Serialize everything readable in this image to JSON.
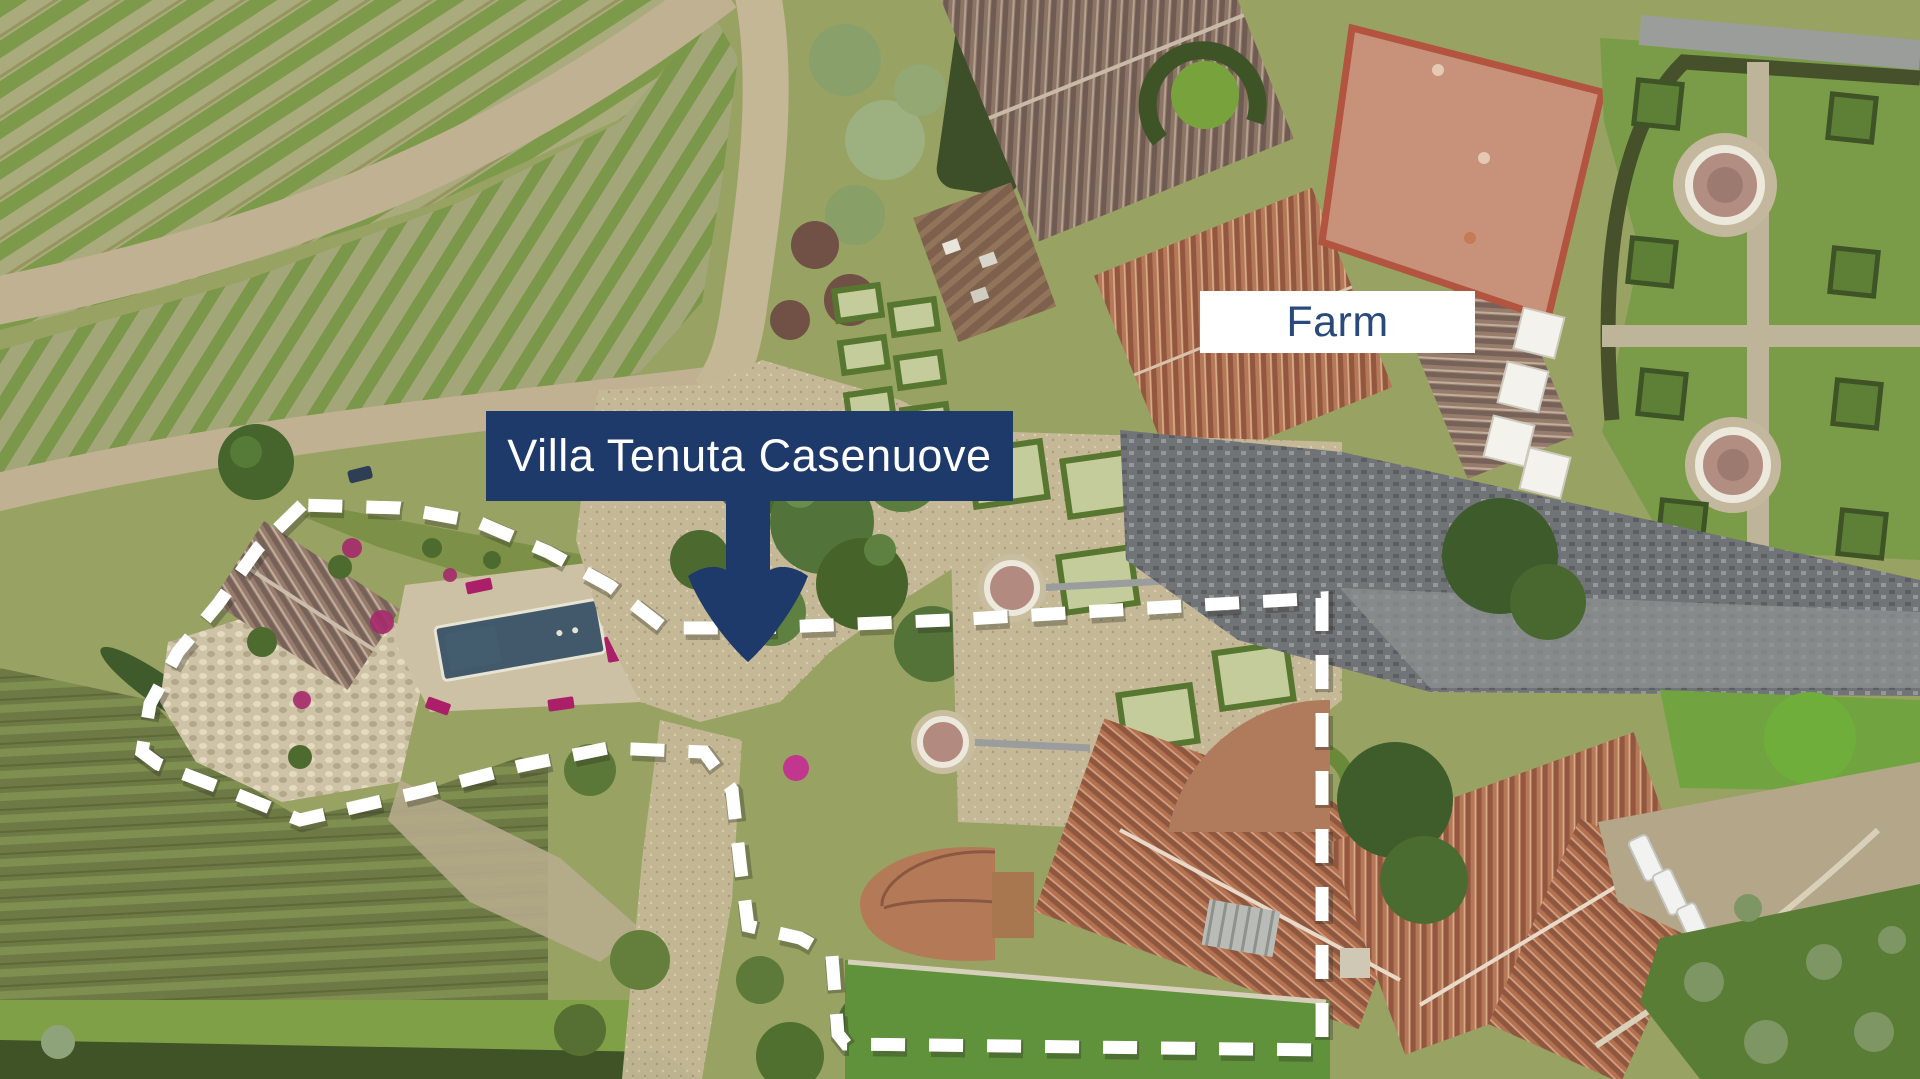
{
  "annotations": {
    "villa_label": {
      "text": "Villa Tenuta Casenuove",
      "bg_color": "#1e3a6a",
      "text_color": "#ffffff"
    },
    "farm_label": {
      "text": "Farm",
      "bg_color": "#ffffff",
      "text_color": "#2b4a7c"
    },
    "arrow": {
      "name": "down-arrow",
      "color": "#1e3a6a",
      "direction": "down"
    },
    "boundary": {
      "name": "property-boundary",
      "style": "dashed",
      "color": "#ffffff"
    }
  },
  "scene_palette": {
    "vine_row_green": "#7d9a4b",
    "vine_soil": "#a9ab7c",
    "dirt_road": "#bfb191",
    "gravel": "#c5b896",
    "lawn": "#6f9f3f",
    "dark_stone": "#717477",
    "terracotta_roof": "#b4714f",
    "weathered_roof": "#8d7566",
    "pool_water": "#41596a",
    "magenta_lounger": "#ab1f68"
  }
}
